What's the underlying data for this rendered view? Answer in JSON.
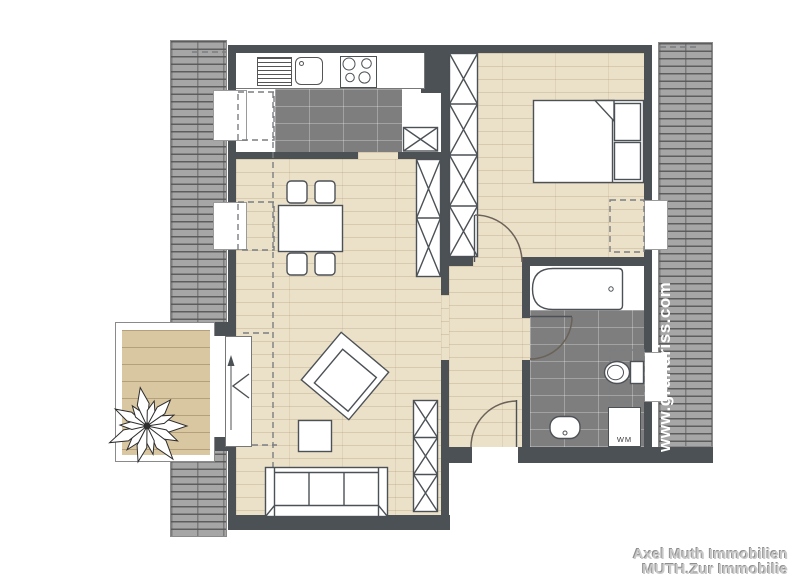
{
  "watermark": {
    "text": "www.grundriss.com"
  },
  "branding": {
    "line1": "Axel Muth Immobilien",
    "line2": "MUTH.Zur Immobilie"
  },
  "labels": {
    "washing_machine": "WM"
  },
  "palette": {
    "wall": "#4c5156",
    "wood": "#ebe0c8",
    "tile": "#7e7e7e",
    "roof": "#a6a6a6",
    "deck": "#d9c7a2",
    "outline": "#4c5156",
    "watermark_text": "#ffffff",
    "branding_text": "#c9c9c9"
  },
  "furniture_icons": [
    "kitchen-counter",
    "drainer",
    "kitchen-sink",
    "stove",
    "dining-table",
    "chair",
    "wardrobe-x",
    "shelf-x",
    "armchair",
    "side-table",
    "sofa",
    "double-bed",
    "pillow",
    "bathtub",
    "toilet",
    "bathroom-sink",
    "washing-machine",
    "plant",
    "balcony-door",
    "room-door",
    "dormer-window",
    "roof-hatch",
    "slope-dashed-line"
  ]
}
